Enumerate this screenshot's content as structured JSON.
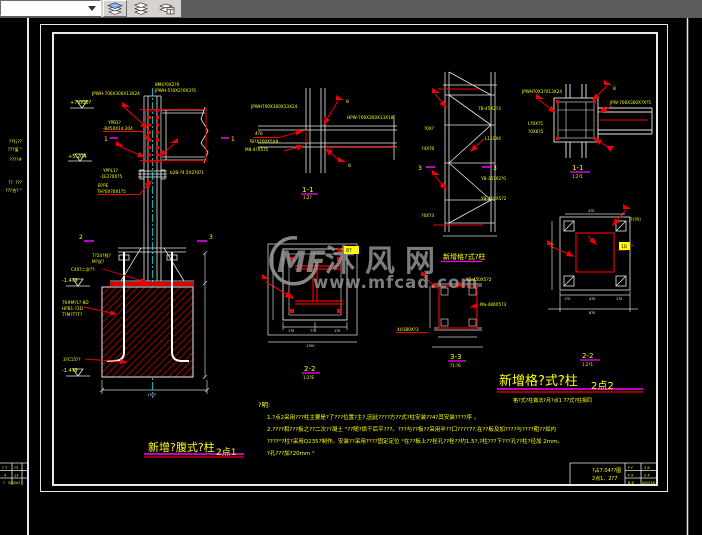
{
  "toolbar": {
    "layer_value": "",
    "buttons": [
      {
        "label": "layers-blue"
      },
      {
        "label": "layers-plain"
      },
      {
        "label": "layer-properties"
      }
    ]
  },
  "watermark": {
    "logo": "MF",
    "site": "沐风网",
    "url": "www.mfcad.com",
    "color": "#969696"
  },
  "colors": {
    "yellow": "#ffff00",
    "white": "#e8e8e8",
    "red": "#f00000",
    "magenta": "#ff00ff",
    "cyan": "#00e0e0",
    "black": "#111111"
  },
  "annotations": [
    {
      "t": "+7.000?",
      "x": 70,
      "y": 104,
      "s": 5,
      "n": "elevation-label"
    },
    {
      "t": "JPWH-700X300X13X24",
      "x": 92,
      "y": 95,
      "s": 4.2
    },
    {
      "t": "8M4?0X2?0",
      "x": 155,
      "y": 86,
      "s": 4.2
    },
    {
      "t": "JPWH-5?0X2?0X3?5",
      "x": 155,
      "y": 92,
      "s": 4.2
    },
    {
      "t": "YPB1?",
      "x": 108,
      "y": 124,
      "s": 4.2
    },
    {
      "t": "-B450X14.204",
      "x": 103,
      "y": 130,
      "s": 4.2
    },
    {
      "t": "1",
      "x": 104,
      "y": 141,
      "s": 6,
      "n": "section-mark-1"
    },
    {
      "t": "1",
      "x": 231,
      "y": 141,
      "s": 6,
      "n": "section-mark-1"
    },
    {
      "t": "+5.204",
      "x": 68,
      "y": 158,
      "s": 5,
      "n": "elevation-label"
    },
    {
      "t": "YPPL1?",
      "x": 103,
      "y": 172,
      "s": 4.2
    },
    {
      "t": "-1E2?0X?5",
      "x": 100,
      "y": 178,
      "s": 4.2
    },
    {
      "t": "b2B-?4.5X2?0?1",
      "x": 170,
      "y": 174,
      "s": 4.2
    },
    {
      "t": "B?PE",
      "x": 98,
      "y": 187,
      "s": 4.2
    },
    {
      "t": "TH?0X?0X1?5",
      "x": 97,
      "y": 193,
      "s": 4.2
    },
    {
      "t": "7?24?栓?",
      "x": 92,
      "y": 257,
      "s": 4.2
    },
    {
      "t": "M?丝?",
      "x": 92,
      "y": 263,
      "s": 4.2
    },
    {
      "t": "C40?二次??:",
      "x": 71,
      "y": 271,
      "s": 4.2
    },
    {
      "t": "-1.4?9",
      "x": 62,
      "y": 282,
      "s": 5,
      "n": "elevation-label"
    },
    {
      "t": "76#M?L?-8D",
      "x": 62,
      "y": 304,
      "s": 4.2
    },
    {
      "t": "HPB1-?2D",
      "x": 62,
      "y": 310,
      "s": 4.2
    },
    {
      "t": "T?M?T?T?",
      "x": 62,
      "y": 316,
      "s": 4.2
    },
    {
      "t": "3?C15??",
      "x": 63,
      "y": 361,
      "s": 4.2
    },
    {
      "t": "-1.4?9",
      "x": 62,
      "y": 372,
      "s": 5,
      "n": "elevation-label"
    },
    {
      "t": "2",
      "x": 79,
      "y": 239,
      "s": 6,
      "n": "section-mark-2"
    },
    {
      "t": "3",
      "x": 209,
      "y": 239,
      "s": 6,
      "n": "section-mark-3"
    },
    {
      "t": "1?0?",
      "x": 147,
      "y": 396,
      "s": 3.8,
      "c": "w"
    },
    {
      "t": "新增?腹式?柱",
      "x": 148,
      "y": 451,
      "s": 11,
      "n": "drawing-title-2dot1"
    },
    {
      "t": "2点1",
      "x": 216,
      "y": 455,
      "s": 9,
      "n": "drawing-title-2dot1-suffix"
    },
    {
      "t": "JPWH700X300X13X24",
      "x": 251,
      "y": 108,
      "s": 4.2
    },
    {
      "t": "HPW-700X300X13X18",
      "x": 347,
      "y": 119,
      "s": 4.2
    },
    {
      "t": "4?0",
      "x": 255,
      "y": 135,
      "s": 4.2
    },
    {
      "t": "?B?X200X5X8",
      "x": 249,
      "y": 143,
      "s": 4.2
    },
    {
      "t": "M8-4?X5?5",
      "x": 245,
      "y": 151,
      "s": 4.2
    },
    {
      "t": "8",
      "x": 346,
      "y": 103,
      "s": 4.5
    },
    {
      "t": "8",
      "x": 348,
      "y": 167,
      "s": 4.5
    },
    {
      "t": "1-1",
      "x": 302,
      "y": 192,
      "s": 7,
      "n": "section-label-1-1"
    },
    {
      "t": "1:2?",
      "x": 303,
      "y": 199,
      "s": 4
    },
    {
      "t": "7B-45X2?3",
      "x": 478,
      "y": 110,
      "s": 4.2
    },
    {
      "t": "L110X4",
      "x": 485,
      "y": 140,
      "s": 4.2
    },
    {
      "t": "YB-35?X2?0",
      "x": 481,
      "y": 180,
      "s": 4.2
    },
    {
      "t": "YB-410X5?2",
      "x": 481,
      "y": 200,
      "s": 4.2
    },
    {
      "t": "?0X?",
      "x": 434,
      "y": 130,
      "s": 4.2,
      "a": "end"
    },
    {
      "t": "?4X?8",
      "x": 434,
      "y": 150,
      "s": 4.2,
      "a": "end"
    },
    {
      "t": "?0X?3",
      "x": 434,
      "y": 217,
      "s": 4.2,
      "a": "end"
    },
    {
      "t": "3",
      "x": 418,
      "y": 170,
      "s": 6,
      "n": "section-mark-3"
    },
    {
      "t": "3",
      "x": 493,
      "y": 170,
      "s": 6,
      "n": "section-mark-3"
    },
    {
      "t": "JPWH?0X3?X13X24",
      "x": 522,
      "y": 93,
      "s": 4.2
    },
    {
      "t": "JPW-700X300X?X?5",
      "x": 610,
      "y": 104,
      "s": 4.2
    },
    {
      "t": "L?0X?5",
      "x": 528,
      "y": 125,
      "s": 4.2
    },
    {
      "t": "?0X6?5",
      "x": 528,
      "y": 133,
      "s": 4.2
    },
    {
      "t": "8",
      "x": 613,
      "y": 90,
      "s": 4.5
    },
    {
      "t": "1-1",
      "x": 572,
      "y": 170,
      "s": 7,
      "n": "section-label-1-1"
    },
    {
      "t": "1:2?1",
      "x": 572,
      "y": 178,
      "s": 4
    },
    {
      "t": "8?",
      "x": 346,
      "y": 252,
      "s": 5,
      "c": "k",
      "n": "weld-tag"
    },
    {
      "t": "2-2",
      "x": 304,
      "y": 371,
      "s": 7,
      "n": "section-label-2-2"
    },
    {
      "t": "1:2?E",
      "x": 303,
      "y": 379,
      "s": 4
    },
    {
      "t": "4U1B0X?3",
      "x": 397,
      "y": 331,
      "s": 4.2
    },
    {
      "t": "1?0",
      "x": 288,
      "y": 332,
      "s": 3.5,
      "c": "w"
    },
    {
      "t": "7?0",
      "x": 310,
      "y": 332,
      "s": 3.5,
      "c": "w"
    },
    {
      "t": "1?0",
      "x": 334,
      "y": 332,
      "s": 3.5,
      "c": "w"
    },
    {
      "t": "1?00",
      "x": 306,
      "y": 347,
      "s": 3.5,
      "c": "w"
    },
    {
      "t": "新增格?式?柱",
      "x": 443,
      "y": 259,
      "s": 7,
      "n": "detail-subtitle"
    },
    {
      "t": "YB-450X5?2",
      "x": 466,
      "y": 281,
      "s": 4.2
    },
    {
      "t": "Ma-480X5?3",
      "x": 480,
      "y": 306,
      "s": 4.2
    },
    {
      "t": "3-3",
      "x": 450,
      "y": 359,
      "s": 7,
      "n": "section-label-3-3"
    },
    {
      "t": "?1:?6",
      "x": 450,
      "y": 367,
      "s": 4
    },
    {
      "t": "J?(?R)",
      "x": 629,
      "y": 221,
      "s": 4.2
    },
    {
      "t": "1B",
      "x": 621,
      "y": 248,
      "s": 4.5,
      "c": "k",
      "n": "weld-tag"
    },
    {
      "t": "2-2",
      "x": 582,
      "y": 358,
      "s": 7,
      "n": "section-label-2-2"
    },
    {
      "t": "1:2?1",
      "x": 582,
      "y": 366,
      "s": 4
    },
    {
      "t": "4?0",
      "x": 588,
      "y": 212,
      "s": 3.5,
      "c": "w"
    },
    {
      "t": "1?0",
      "x": 564,
      "y": 300,
      "s": 3.5,
      "c": "w"
    },
    {
      "t": "4?0",
      "x": 589,
      "y": 300,
      "s": 3.5,
      "c": "w"
    },
    {
      "t": "1?0",
      "x": 616,
      "y": 300,
      "s": 3.5,
      "c": "w"
    },
    {
      "t": "8?0",
      "x": 589,
      "y": 314,
      "s": 3.5,
      "c": "w"
    },
    {
      "t": "新增格?式?柱",
      "x": 499,
      "y": 385,
      "s": 13,
      "n": "drawing-title-2dot2"
    },
    {
      "t": "2点2",
      "x": 591,
      "y": 389,
      "s": 10,
      "n": "drawing-title-2dot2-suffix"
    },
    {
      "t": "格?式?柱做法?月?点1 7?式?柱相同",
      "x": 513,
      "y": 402,
      "s": 5,
      "n": "drawing-subtitle"
    },
    {
      "t": "?明:",
      "x": 258,
      "y": 407,
      "s": 6.5,
      "n": "notes-heading"
    },
    {
      "t": "1.?点2采用???柱主要是?了???位置?主?,因此????方??式?柱安装??4?其安装????序 。",
      "x": 267,
      "y": 419,
      "s": 5.5,
      "n": "note-line-1"
    },
    {
      "t": "2.????和???板之??二次??凝土 °??随?烘干后平???。???与??板??采用半??口????7?,在??板及加????与????粗??如内",
      "x": 267,
      "y": 431,
      "s": 5.5,
      "n": "note-line-2"
    },
    {
      "t": "????°?柱?采用Q235?制作。安装??采用????固定定位 °在??板上??栓孔??栓??约1.5?,?柱???下???孔??柱?径加 2mm。",
      "x": 267,
      "y": 443,
      "s": 5.5,
      "n": "note-line-3"
    },
    {
      "t": "?孔???加?20mm °",
      "x": 267,
      "y": 455,
      "s": 5.5,
      "n": "note-line-4"
    },
    {
      "t": "?占7.04??图",
      "x": 592,
      "y": 472,
      "s": 5,
      "n": "titleblock-drawing-name"
    },
    {
      "t": "2点1、2?7",
      "x": 592,
      "y": 480,
      "s": 5,
      "n": "titleblock-drawing-number"
    },
    {
      "t": "F F",
      "x": 628,
      "y": 469,
      "s": 3.5
    },
    {
      "t": "3 8",
      "x": 644,
      "y": 469,
      "s": 3.5
    },
    {
      "t": "F 9",
      "x": 628,
      "y": 476.5,
      "s": 3.5
    },
    {
      "t": "2 4",
      "x": 644,
      "y": 476.5,
      "s": 3.5
    },
    {
      "t": "B 8",
      "x": 628,
      "y": 484,
      "s": 3.5
    },
    {
      "t": "500?48",
      "x": 642,
      "y": 484,
      "s": 3.5
    },
    {
      "t": "? 7",
      "x": 2,
      "y": 469,
      "s": 3.5
    },
    {
      "t": "?3",
      "x": 14,
      "y": 469,
      "s": 3.5
    },
    {
      "t": "4",
      "x": 4,
      "y": 476.5,
      "s": 3.5
    },
    {
      "t": "13",
      "x": 14,
      "y": 476.5,
      "s": 3.5
    },
    {
      "t": "?",
      "x": 3,
      "y": 484,
      "s": 3.5
    },
    {
      "t": "200/A?",
      "x": 8,
      "y": 484,
      "s": 3.5
    },
    {
      "t": "??行??",
      "x": 22,
      "y": 143,
      "s": 4.2,
      "a": "end"
    },
    {
      "t": "???值 °",
      "x": 22,
      "y": 151,
      "s": 4.2,
      "a": "end"
    },
    {
      "t": "????#",
      "x": 22,
      "y": 161,
      "s": 4.2,
      "a": "end"
    },
    {
      "t": "??. ???",
      "x": 22,
      "y": 184,
      "s": 4.2,
      "a": "end"
    },
    {
      "t": "???合? °",
      "x": 22,
      "y": 192,
      "s": 4.2,
      "a": "end"
    }
  ]
}
